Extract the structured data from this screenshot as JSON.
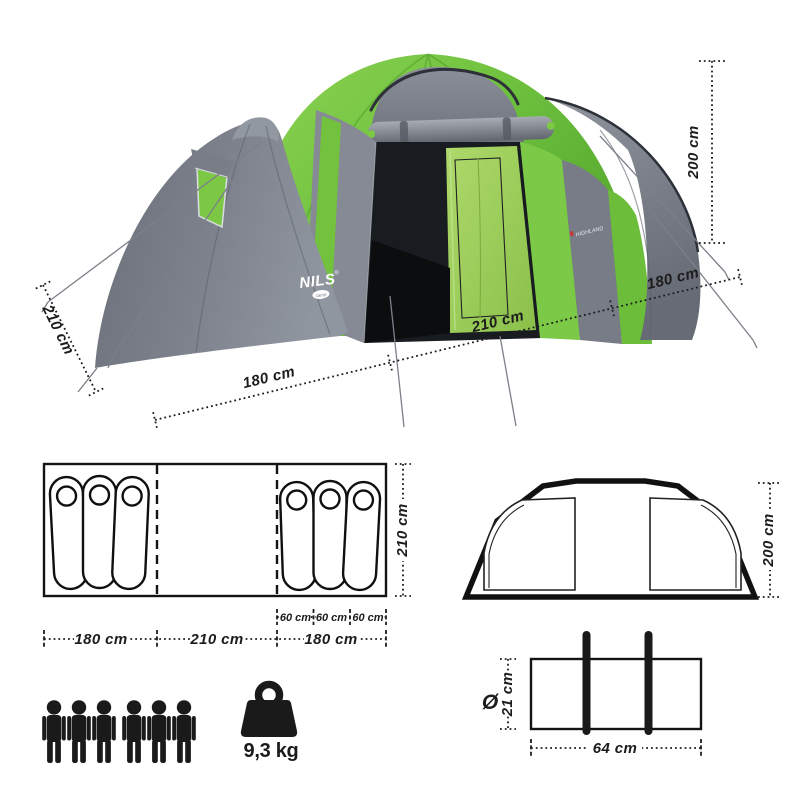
{
  "product": {
    "brand": "NILS",
    "brand_reg": "®",
    "brand_badge": "camp",
    "model_label": "HIGHLAND",
    "weight": "9,3 kg",
    "capacity_persons": 6
  },
  "photo_dims": {
    "height": "200 cm",
    "side_depth": "210 cm",
    "front_left": "180 cm",
    "front_middle": "210 cm",
    "front_right": "180 cm"
  },
  "floor_plan": {
    "depth": "210 cm",
    "section_widths": [
      "180 cm",
      "210 cm",
      "180 cm"
    ],
    "bag_widths": [
      "60 cm",
      "60 cm",
      "60 cm"
    ],
    "bags_left": 3,
    "bags_right": 3
  },
  "front_view": {
    "height": "200 cm"
  },
  "packed": {
    "diameter_sign": "Ø",
    "diameter": "21 cm",
    "length": "64 cm"
  },
  "colors": {
    "tent_green": "#6ec13e",
    "tent_green_dark": "#4f9e2c",
    "tent_gray": "#7c818b",
    "tent_gray_dark": "#5d626b",
    "inner_green": "#9bd058",
    "line": "#1c1c1c"
  }
}
